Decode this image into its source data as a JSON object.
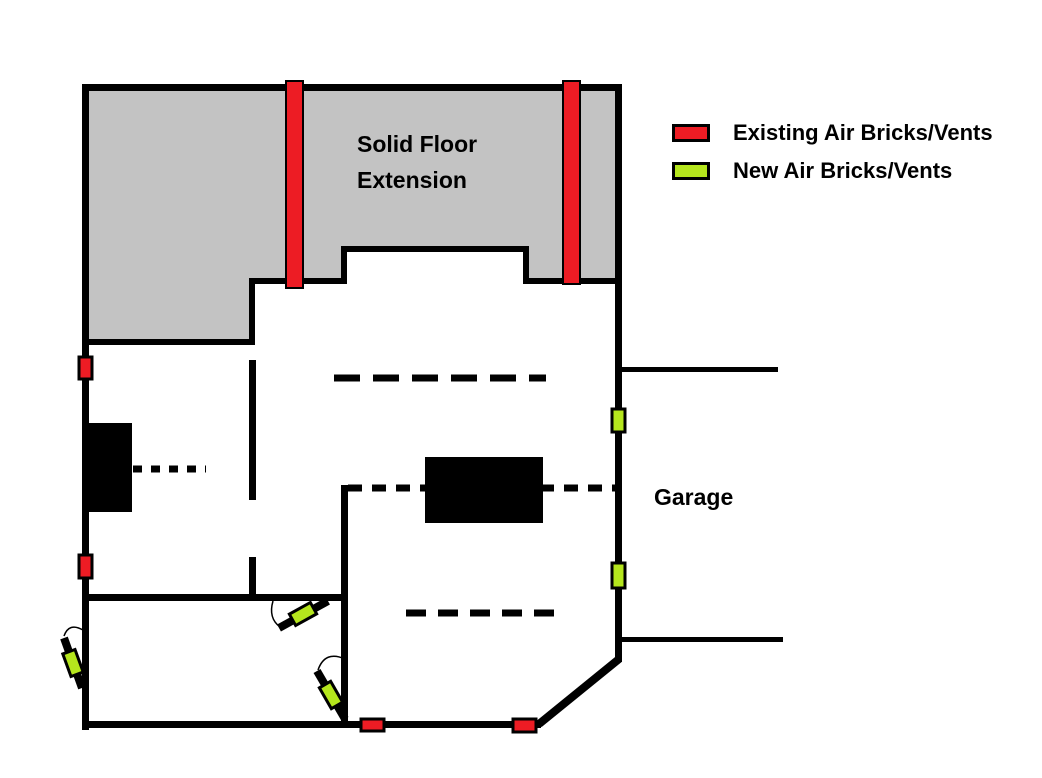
{
  "colors": {
    "existing": "#ED1C24",
    "new": "#B5E61D",
    "extension_fill": "#C3C3C3",
    "line": "#000000"
  },
  "legend": {
    "items": [
      {
        "label": "Existing Air Bricks/Vents"
      },
      {
        "label": "New Air Bricks/Vents"
      }
    ]
  },
  "labels": {
    "solid_floor_extension": [
      "Solid Floor",
      "Extension"
    ],
    "garage": "Garage"
  }
}
